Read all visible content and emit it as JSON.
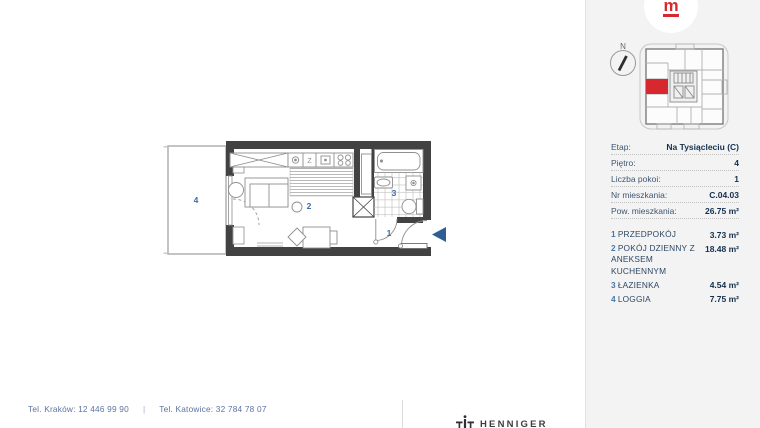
{
  "brand": {
    "logo_letter": "m"
  },
  "colors": {
    "accent_red": "#d7282f",
    "navy_text": "#14304e",
    "plan_label_blue": "#3a6ca6",
    "wall_gray": "#424242",
    "entrance_arrow_blue": "#2d5f93",
    "panel_bg": "#f3f3f4"
  },
  "site_plan": {
    "compass_label": "N"
  },
  "floor_plan": {
    "labels": {
      "hall": "1",
      "living": "2",
      "bath": "3",
      "loggia": "4"
    },
    "kitchen_sink_label": "Z"
  },
  "info": {
    "rows": [
      {
        "label": "Etap:",
        "value": "Na Tysiącleciu (C)"
      },
      {
        "label": "Piętro:",
        "value": "4"
      },
      {
        "label": "Liczba pokoi:",
        "value": "1"
      },
      {
        "label": "Nr mieszkania:",
        "value": "C.04.03"
      },
      {
        "label": "Pow. mieszkania:",
        "value": "26.75 m²"
      }
    ]
  },
  "rooms": [
    {
      "num": "1",
      "name": "PRZEDPOKÓJ",
      "area": "3.73 m²"
    },
    {
      "num": "2",
      "name": "POKÓJ DZIENNY Z ANEKSEM KUCHENNYM",
      "area": "18.48 m²"
    },
    {
      "num": "3",
      "name": "ŁAZIENKA",
      "area": "4.54 m²"
    },
    {
      "num": "4",
      "name": "LOGGIA",
      "area": "7.75 m²"
    }
  ],
  "footer": {
    "phone_krakow": "Tel. Kraków: 12 446 99 90",
    "separator": "|",
    "phone_katowice": "Tel. Katowice: 32 784 78 07",
    "partner_logo": "HENNIGER"
  }
}
